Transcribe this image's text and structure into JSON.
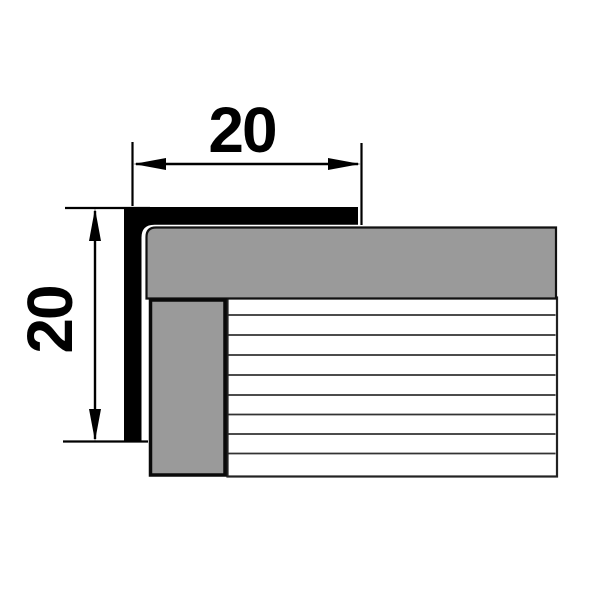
{
  "diagram": {
    "type": "technical-cross-section",
    "dimension_top": {
      "value": "20"
    },
    "dimension_left": {
      "value": "20"
    },
    "colors": {
      "background": "#ffffff",
      "profile_fill": "#000000",
      "panel_fill": "#9a9a9a",
      "panel_stroke": "#111111",
      "wall_stroke": "#0a0a0a",
      "laminate_fill": "#ffffff",
      "laminate_stroke": "#222222",
      "hatch_stroke": "#333333",
      "dimension_color": "#000000"
    },
    "hatch": {
      "lines_y": [
        315,
        335,
        355,
        375,
        395,
        414.5,
        434,
        453.5
      ],
      "x_start": 228.5,
      "x_end": 555.5,
      "stroke_width": 1.8
    }
  }
}
